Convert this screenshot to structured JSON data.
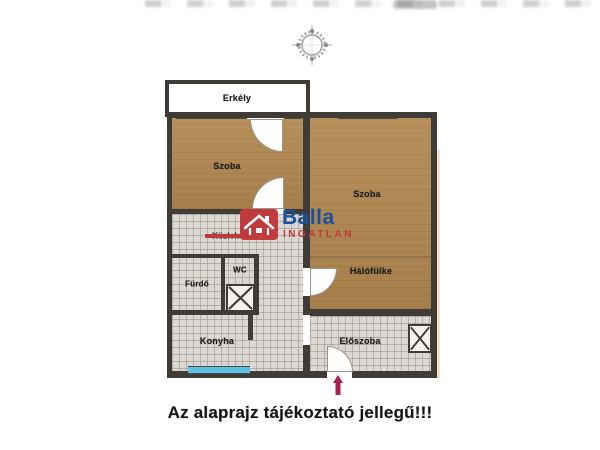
{
  "plan": {
    "rooms": {
      "erkely": {
        "label": "Erkély"
      },
      "szoba_left": {
        "label": "Szoba"
      },
      "szoba_right": {
        "label": "Szoba"
      },
      "kozlekedo": {
        "label": "Közlekedő"
      },
      "furdo": {
        "label": "Fürdő"
      },
      "wc": {
        "label": "WC"
      },
      "halofulke": {
        "label": "Hálófülke"
      },
      "konyha": {
        "label": "Konyha"
      },
      "eloszoba": {
        "label": "Előszoba"
      }
    }
  },
  "watermark": {
    "brand": "Balla",
    "subtitle": "INGATLAN"
  },
  "disclaimer": "Az alaprajz tájékoztató jellegű!!!",
  "colors": {
    "wood_floor": "#b1874f",
    "tile_floor": "#dbd8d3",
    "wall": "#3f3b36",
    "window_glass": "#8cc6de",
    "kitchen_window": "#5ec3e2",
    "brand_red": "#c13a3e",
    "brand_blue": "#1b4f9f",
    "entrance_arrow": "#a92052"
  }
}
